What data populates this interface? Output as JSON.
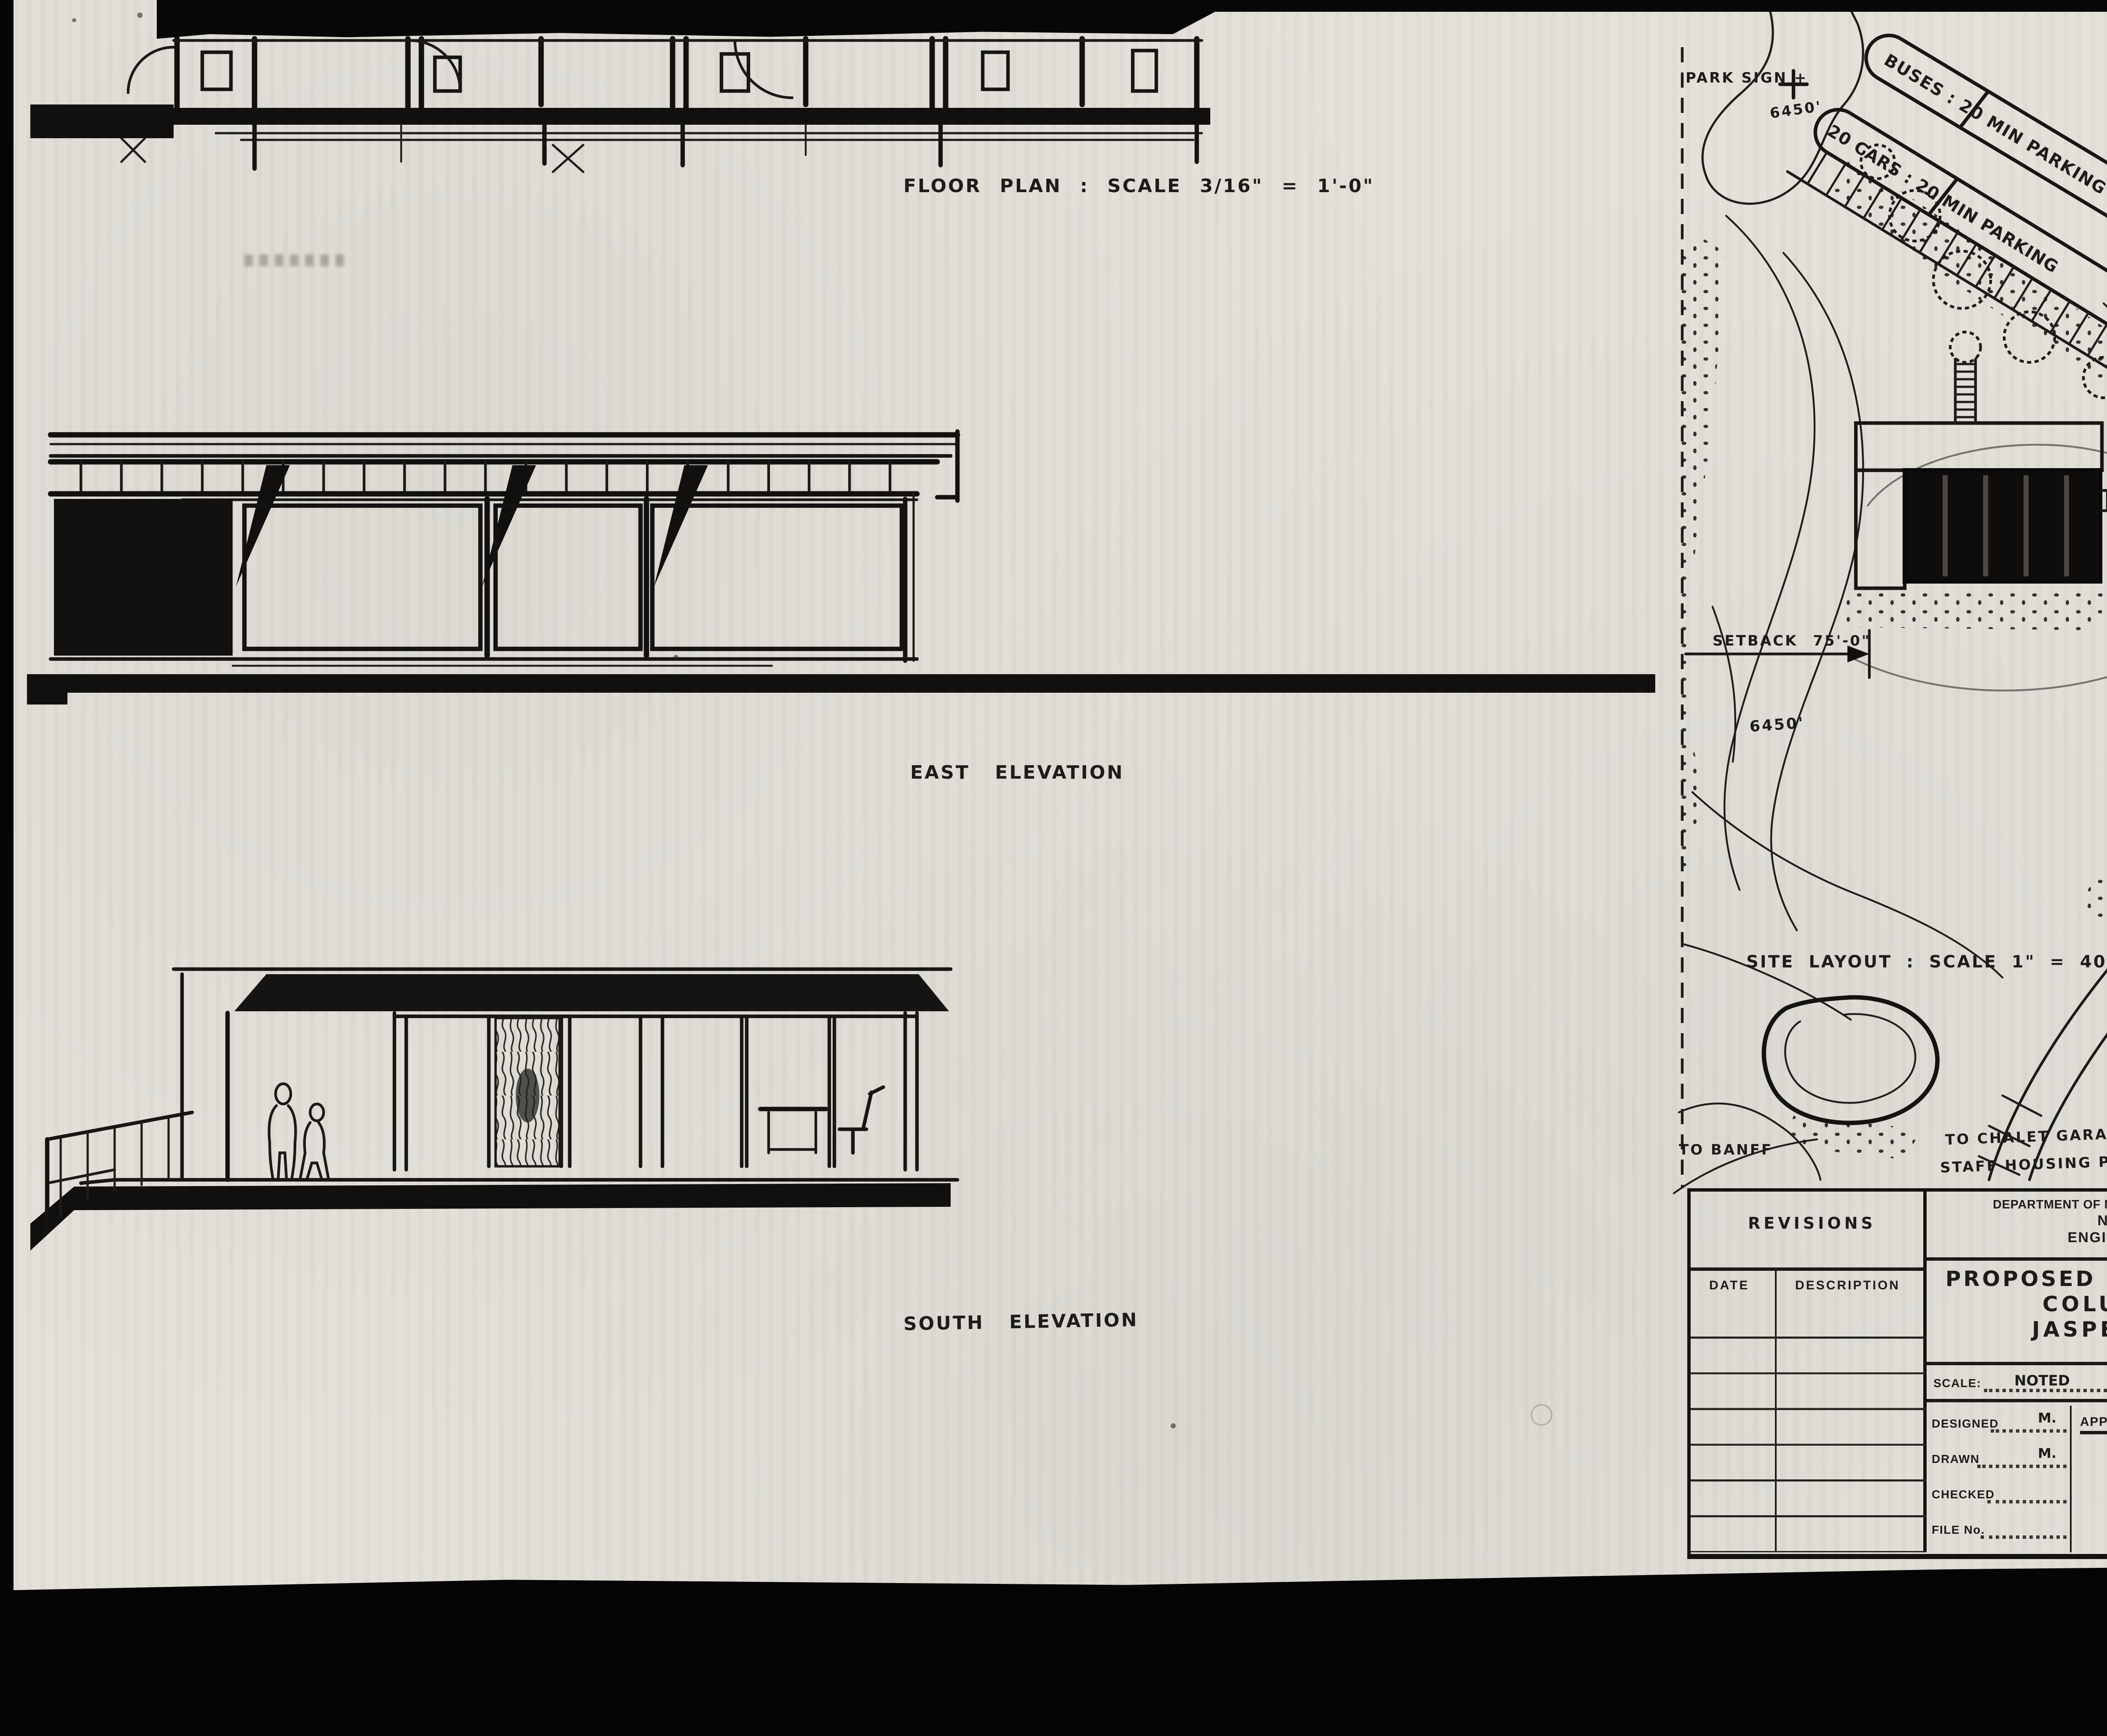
{
  "captions": {
    "floor_plan": "FLOOR PLAN : SCALE 3/16\" = 1'-0\"",
    "east_elevation": "EAST ELEVATION",
    "south_elevation": "SOUTH ELEVATION",
    "site_layout": "SITE LAYOUT : SCALE 1\" = 40' . CONTOUR INTERVALS 2'-0\""
  },
  "site_plan": {
    "park_sign": "PARK SIGN +",
    "spot_elev_park_sign": "6450'",
    "buses_parking": "BUSES : 20 MIN PARKING",
    "cars_parking": "20 CARS : 20 MIN PARKING",
    "out_only": "OUT ONLY",
    "setback_dim": "SETBACK 75'-0\"",
    "contour_6450": "6450'",
    "contour_6470": "6470'",
    "to_banff": "TO BANFF",
    "to_chalet_line1": "TO CHALET GARAGE &",
    "to_chalet_line2": "STAFF HOUSING PROPOSED",
    "north_label": "NORTH PT"
  },
  "title_block": {
    "department_line1": "DEPARTMENT OF NORTHERN AFFAIRS AND NATIONAL RESOURCES",
    "department_line2": "NATIONAL PARKS BRANCH",
    "department_line3": "ENGINEERING SERVICES DIVISION",
    "revisions_title": "REVISIONS",
    "revisions_col_date": "DATE",
    "revisions_col_description": "DESCRIPTION",
    "project_title_line1": "PROPOSED INFORMATION BUILDING",
    "project_title_line2": "COLUMBIA ICEFIELDS",
    "project_title_line3": "JASPER NATIONAL PK.",
    "scale_label": "SCALE:",
    "scale_value": "NOTED",
    "date_label": "DATE:",
    "date_value": "SEPT 20 1961",
    "designed_label": "DESIGNED",
    "designed_value": "M.",
    "drawn_label": "DRAWN",
    "drawn_value": "M.",
    "checked_label": "CHECKED",
    "file_no_label": "FILE No.",
    "approved_label": "APPROVED",
    "chief_engineer_label": "CHIEF ENGINEER",
    "index_no_label": "INDEX No.",
    "index_no_value": "J-75",
    "sheet_no_label": "SHEET No.",
    "sheet_no_value": "SK-6",
    "job_no_label": "JOB No."
  },
  "stamp": {
    "page_label": "4 of/de 4"
  }
}
